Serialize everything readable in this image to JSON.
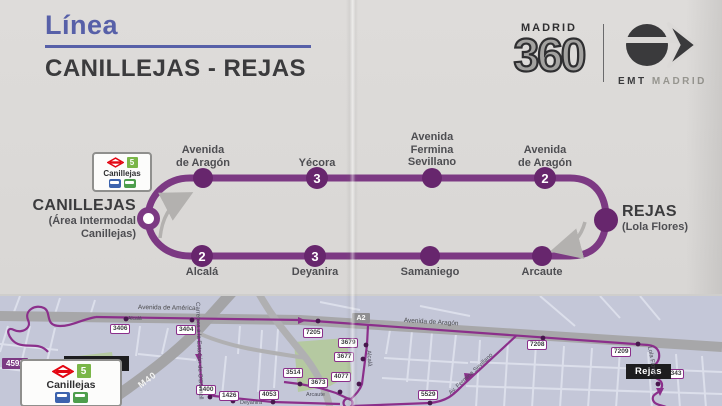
{
  "header": {
    "line_word": "Línea",
    "route_name": "CANILLEJAS - REJAS"
  },
  "logos": {
    "madrid360": {
      "word": "MADRID",
      "number": "360"
    },
    "emt": {
      "name": "EMT",
      "city": "MADRID"
    }
  },
  "diagram": {
    "origin": {
      "name": "CANILLEJAS",
      "sub1": "(Área Intermodal",
      "sub2": "Canillejas)"
    },
    "destination": {
      "name": "REJAS",
      "sub": "(Lola Flores)"
    },
    "badge": {
      "line": "5",
      "station": "Canillejas"
    },
    "stops_top": [
      {
        "l1": "Avenida",
        "l2": "de Aragón"
      },
      {
        "l1": "Yécora",
        "num": "3"
      },
      {
        "l1": "Avenida",
        "l2": "Fermina",
        "l3": "Sevillano"
      },
      {
        "l1": "Avenida",
        "l2": "de Aragón",
        "num": "2"
      }
    ],
    "stops_bottom": [
      {
        "l1": "Alcalá",
        "num": "2"
      },
      {
        "l1": "Deyanira",
        "num": "3"
      },
      {
        "l1": "Samaniego"
      },
      {
        "l1": "Arcaute"
      }
    ]
  },
  "map": {
    "roads": {
      "avenida_america": "Avenida de América",
      "a2": "A2",
      "avenida_aragon": "Avenida de Aragón",
      "m40": "M40"
    },
    "streets": {
      "carretera": "Carretera a la Estación de O'Donnell",
      "alcala_v": "Alcalá",
      "alcala_small": "Alcalá",
      "fermina": "Av. Fermina Sevillano",
      "lola": "Lola Flores",
      "arcaute": "Arcaute",
      "deyanira": "Deyanira"
    },
    "origin_code": "4592",
    "origin_name": "Canillejas",
    "dest_name": "Rejas",
    "badge": {
      "line": "5",
      "station": "Canillejas"
    },
    "codes": {
      "c3406": "3406",
      "c3404": "3404",
      "c7205": "7205",
      "c7208": "7208",
      "c7209": "7209",
      "c3679": "3679",
      "c3677": "3677",
      "c4077": "4077",
      "c3673": "3673",
      "c3514": "3514",
      "c4053": "4053",
      "c1400": "1400",
      "c1426": "1426",
      "c5529": "5529",
      "c5343": "5343"
    }
  },
  "colors": {
    "line_purple": "#7c3983",
    "dot_purple": "#67266d",
    "title_blue": "#5760a8",
    "map_route": "#8b2f8b",
    "metro_green": "#7ab648",
    "metro_red": "#e30613",
    "map_bg": "#c4c7d8"
  }
}
